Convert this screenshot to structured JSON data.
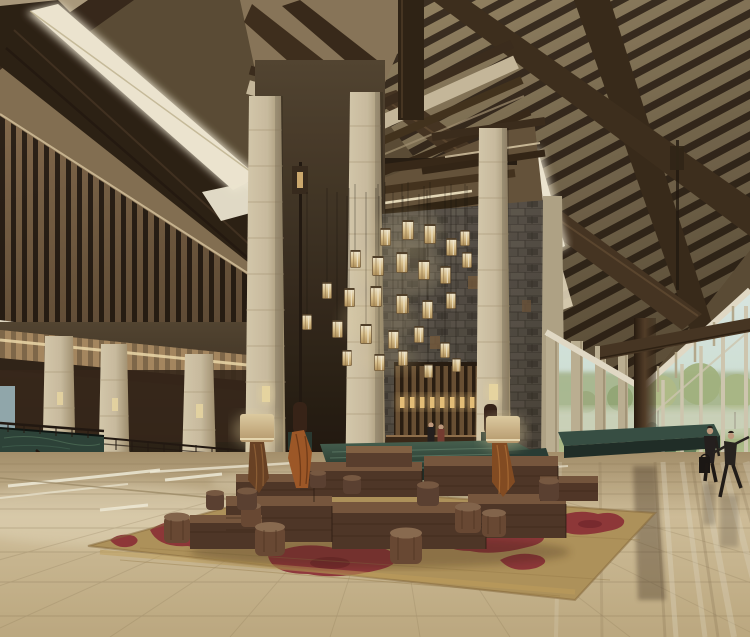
{
  "scene": {
    "type": "architectural-interior-rendering",
    "description": "Photorealistic rendering of a resort hotel lobby: high vaulted timber roof with exposed dark rafters and linear skylights, a cluster of glowing rectangular glass pendant lanterns hanging in a tall stone-clad atrium, beige stone columns, a left reception colonnade with green-marble counter and backlit wooden slats, a central green-marble water platform, low dark-wood block benches and drum stools on a red-and-gold patterned rug, a polished reflective travertine floor, and a right-hand floor-to-ceiling window wall looking onto trees and lawn with two walking figures.",
    "objects": [
      "vaulted-timber-ceiling",
      "linear-skylights",
      "louvered-wood-screen",
      "gable-truss",
      "pendant-lantern-chandelier",
      "stone-columns",
      "gray-stone-feature-wall",
      "reception-desk",
      "backlit-slat-screen",
      "reception-staff-figures",
      "left-colonnade",
      "green-marble-counter",
      "railings-and-steps",
      "green-marble-water-platform",
      "floor-lamps",
      "carved-wood-sculptures",
      "wood-block-benches",
      "wood-drum-stools",
      "patterned-area-rug",
      "polished-marble-floor",
      "window-wall",
      "outdoor-trees-and-lawn",
      "walking-guests",
      "floor-reflections"
    ],
    "people_count": 4
  },
  "palette": {
    "ceilTan": "#9c8a68",
    "ceilPanel": "#c2b190",
    "woodDark": "#3a2c1e",
    "woodBeam": "#4e3b27",
    "woodMid": "#7a5f42",
    "skylight": "#f8f0da",
    "stoneBeige": "#d2c4a6",
    "stoneJoint": "#a89574",
    "stoneGray": "#5f584e",
    "interiorDark": "#2e241a",
    "coveWarm": "#d9ae74",
    "glowWarm": "#f2dfa8",
    "marbleGreen": "#3c544a",
    "marbleGreenDark": "#22302a",
    "floorBeige": "#cbb892",
    "floorLight": "#e9dab6",
    "floorLine": "#8d7a58",
    "rugRed": "#93323a",
    "rugTan": "#b7995f",
    "benchWood": "#53392a",
    "benchTop": "#7d5b41",
    "stoolWood": "#6e4c36",
    "windowSky": "#e4f2ec",
    "foliage": "#a9b888",
    "foliageDark": "#5e7a58",
    "lawn": "#a8ba85",
    "mullion": "#d8d0b8",
    "whiteTrim": "#ece4cf",
    "figureDark": "#262120",
    "skinTone": "#c9a183"
  }
}
